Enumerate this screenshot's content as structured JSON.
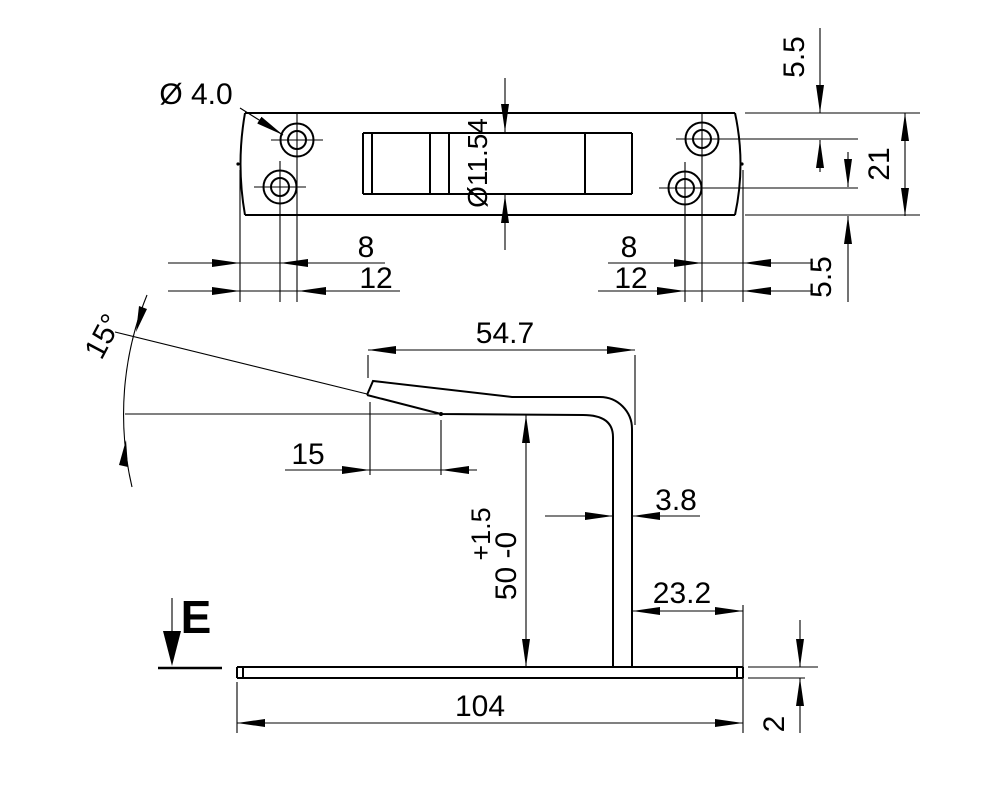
{
  "colors": {
    "line": "#000000",
    "background": "#ffffff"
  },
  "top_view": {
    "hole_diameter_label": "Ø 4.0",
    "slot_width_label": "Ø11.54",
    "edge_to_hole_top": "5.5",
    "plate_width": "21",
    "edge_to_hole_bottom": "5.5",
    "hole_offset_short": "8",
    "hole_offset_long": "12"
  },
  "side_view": {
    "bend_angle": "15°",
    "top_length": "54.7",
    "tab_length": "15",
    "height_main": "50 -0",
    "height_tolerance_plus": "+1.5",
    "leg_thickness": "3.8",
    "leg_to_edge": "23.2",
    "base_length": "104",
    "base_thickness": "2",
    "view_direction_label": "E"
  }
}
